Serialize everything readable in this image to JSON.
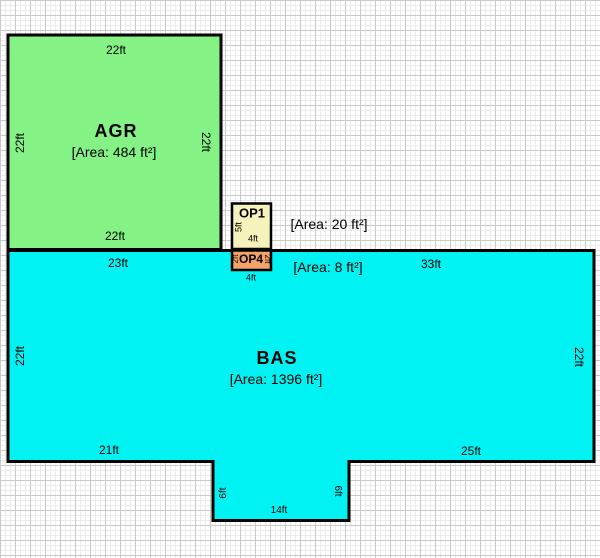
{
  "canvas": {
    "border_color": "#000000",
    "grid_minor_color": "#ebebeb",
    "grid_major_color": "#c9c9c9"
  },
  "agr": {
    "name": "AGR",
    "area": "[Area: 484 ft²]",
    "fill": "#85F285",
    "dim_top": "22ft",
    "dim_left": "22ft",
    "dim_right": "22ft",
    "dim_bottom": "22ft"
  },
  "bas": {
    "name": "BAS",
    "area": "[Area: 1396 ft²]",
    "fill": "#00F2F2",
    "dim_top_left": "23ft",
    "dim_top_right": "33ft",
    "dim_left": "22ft",
    "dim_right": "22ft",
    "dim_bottom_left": "21ft",
    "dim_bottom_right": "25ft",
    "dim_notch_left": "6ft",
    "dim_notch_right": "6ft",
    "dim_notch_bottom": "14ft"
  },
  "op1": {
    "name": "OP1",
    "area": "[Area: 20 ft²]",
    "fill": "#F6F2BC",
    "dim_left": "5ft",
    "dim_bottom": "4ft"
  },
  "op4": {
    "name": "OP4",
    "area": "[Area: 8 ft²]",
    "fill": "#F2A368",
    "dim_left": "2ft",
    "dim_right": "2ft",
    "dim_bottom": "4ft"
  }
}
